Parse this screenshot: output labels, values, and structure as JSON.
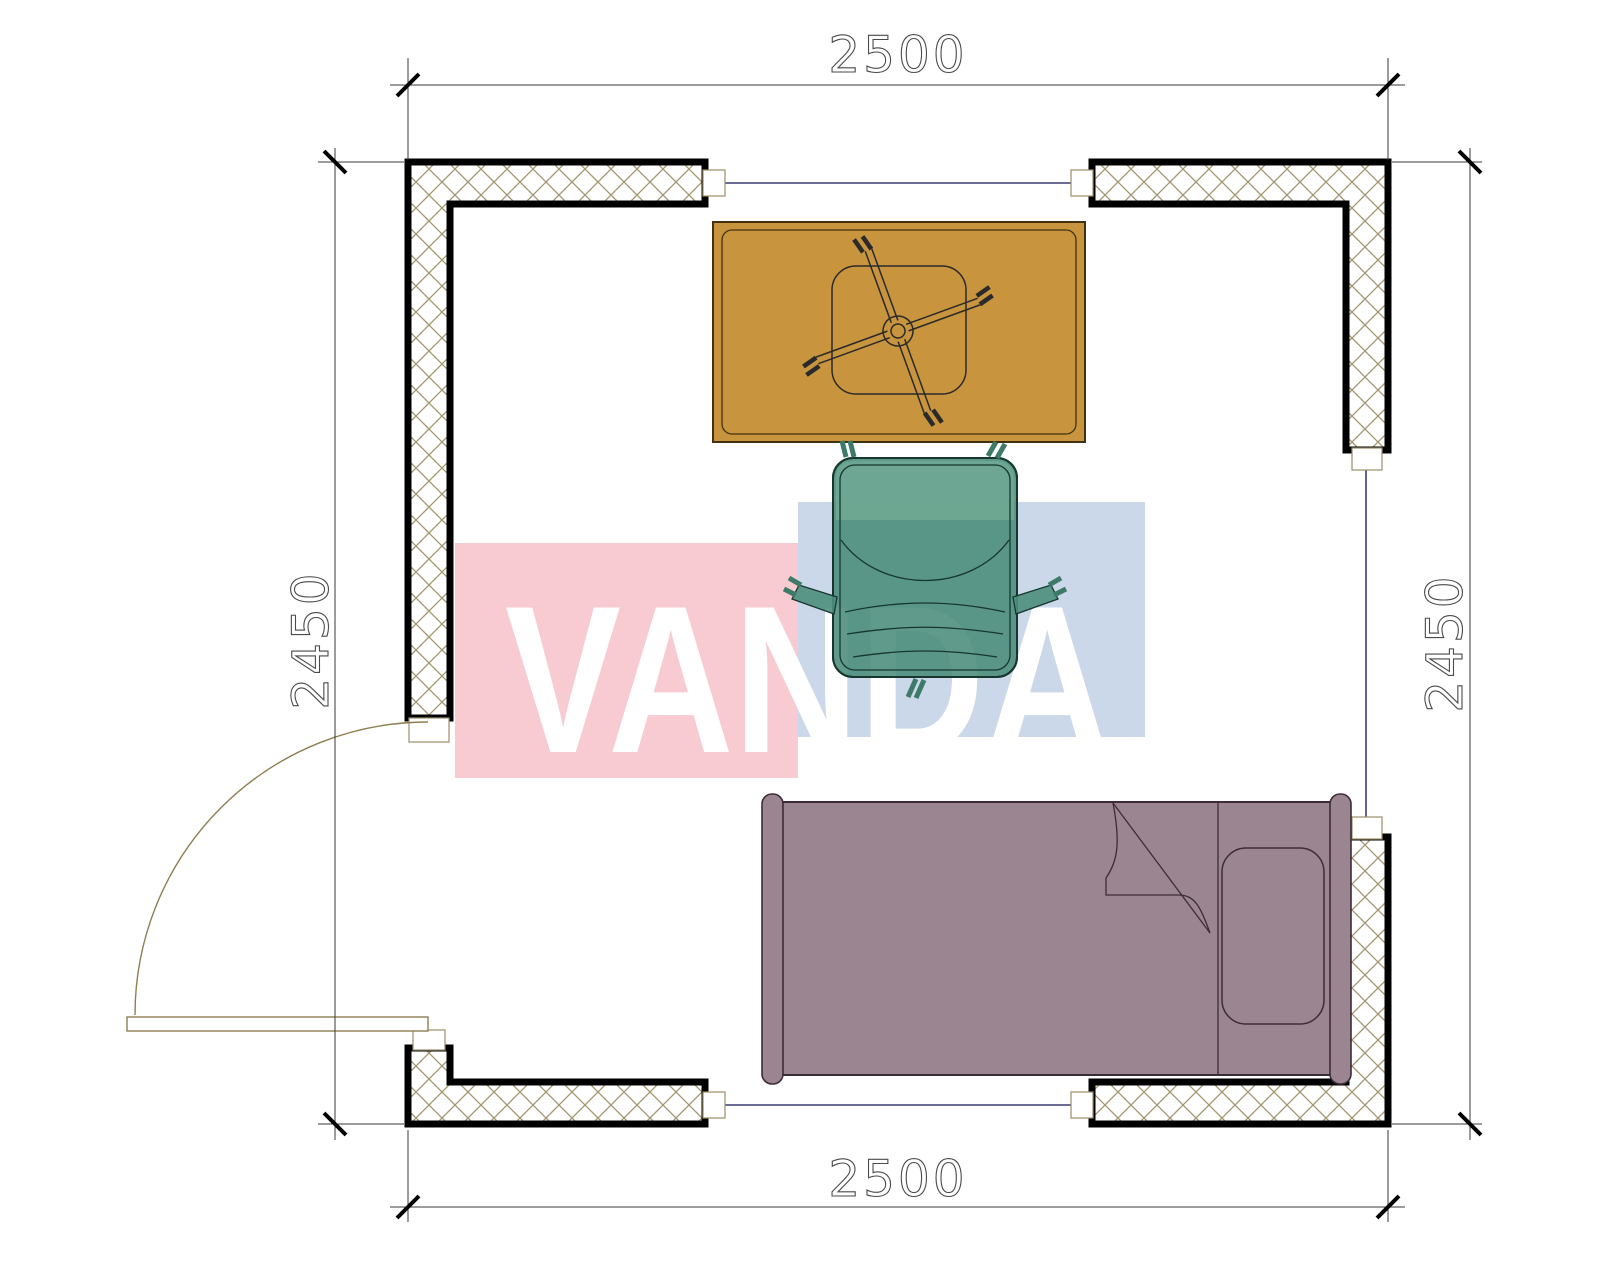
{
  "drawing": {
    "type": "floor-plan",
    "dimensions": {
      "top": "2500",
      "bottom": "2500",
      "left": "2450",
      "right": "2450"
    },
    "watermark": {
      "text": "VANDA",
      "red_block_color": "#f8cad1",
      "blue_block_color": "#cbd8e9",
      "text_color": "#ffffff"
    },
    "furniture": {
      "desk_color": "#c8943e",
      "chair_color": "#4e8f7d",
      "chair_light_color": "#6fa893",
      "bed_color": "#9b8591"
    },
    "colors": {
      "wall_outline": "#000000",
      "wall_hatch": "#a3956f",
      "window_line": "#3c3c70",
      "door_line": "#8f7e52",
      "dimension_line": "#3a3a3a"
    }
  }
}
